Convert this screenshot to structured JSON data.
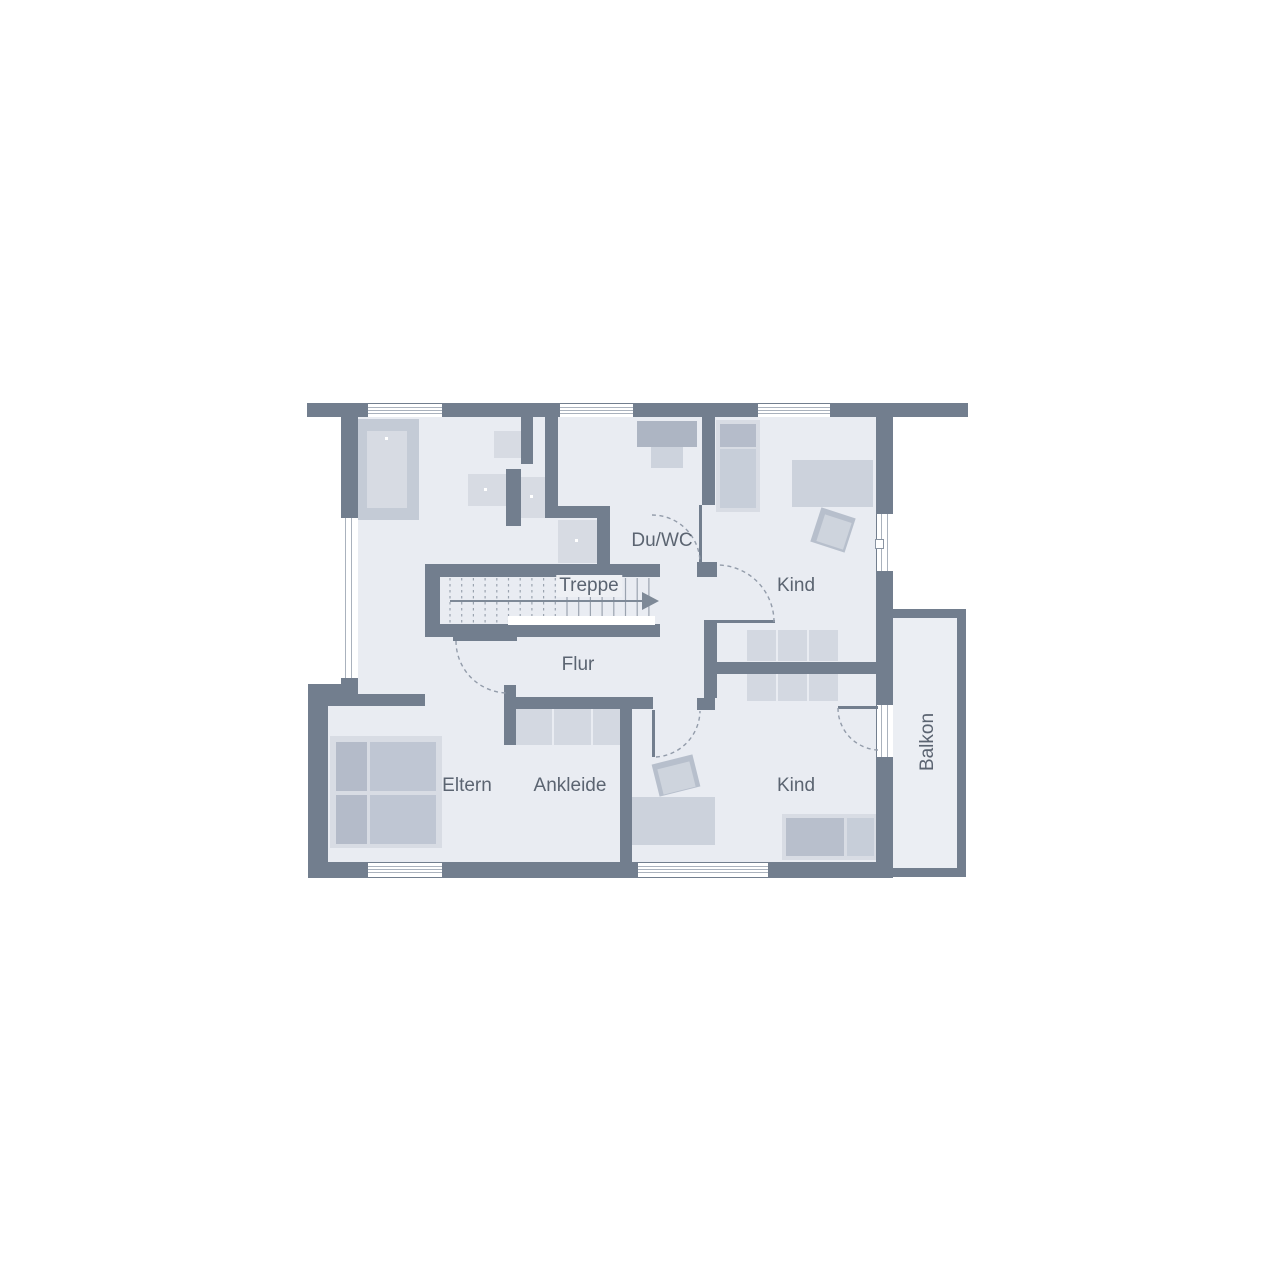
{
  "plan": {
    "type": "floor-plan",
    "floor_background": "#e9ecf2",
    "wall_color": "#727e8e",
    "text_color": "#5b6471"
  },
  "rooms": [
    {
      "id": "du-wc",
      "label": "Du/WC"
    },
    {
      "id": "treppe",
      "label": "Treppe"
    },
    {
      "id": "kind-top",
      "label": "Kind"
    },
    {
      "id": "flur",
      "label": "Flur"
    },
    {
      "id": "eltern",
      "label": "Eltern"
    },
    {
      "id": "ankleide",
      "label": "Ankleide"
    },
    {
      "id": "kind-bottom",
      "label": "Kind"
    },
    {
      "id": "balkon",
      "label": "Balkon",
      "rotated": true
    }
  ]
}
